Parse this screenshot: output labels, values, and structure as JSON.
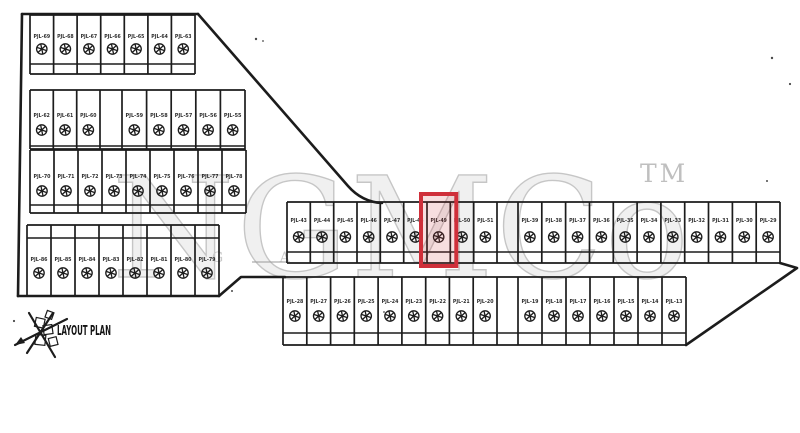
{
  "legend": {
    "title": "LAYOUT PLAN"
  },
  "watermark": {
    "text": "NGMCo",
    "tm": "TM",
    "subtitle": "G A"
  },
  "icons": {
    "plot_marker_icon": "circled-asterisk",
    "north_arrow_icon": "hand-drawn-north-star"
  },
  "style": {
    "ink": "#1c1c1c",
    "highlight_border": "#cf2f3a",
    "highlight_fill": "rgba(207,47,58,0.16)",
    "watermark_color": "#c6c6c6",
    "paper": "#ffffff"
  },
  "highlight": {
    "row_id": "mid-row",
    "group": 0,
    "plot_index": 6,
    "label": "PJL-49"
  },
  "rows": [
    {
      "id": "left-top-row",
      "top": 15,
      "bottom": 74,
      "band": 64,
      "label_y": 38,
      "circle_y": 49,
      "groups": [
        {
          "x0": 30,
          "x1": 195,
          "labels": [
            "PJL-69",
            "PJL-68",
            "PJL-67",
            "PJL-66",
            "PJL-65",
            "PJL-64",
            "PJL-63"
          ]
        }
      ]
    },
    {
      "id": "left-row-2",
      "top": 90,
      "bottom": 149,
      "band": 146,
      "label_y": 117,
      "circle_y": 130,
      "groups": [
        {
          "x0": 30,
          "x1": 100,
          "labels": [
            "PJL-62",
            "PJL-61",
            "PJL-60"
          ]
        },
        {
          "x0": 122,
          "x1": 245,
          "labels": [
            "PJL-59",
            "PJL-58",
            "PJL-57",
            "PJL-56",
            "PJL-55"
          ]
        }
      ]
    },
    {
      "id": "left-row-3",
      "top": 150,
      "bottom": 213,
      "band": 205,
      "label_y": 178,
      "circle_y": 191,
      "groups": [
        {
          "x0": 30,
          "x1": 246,
          "labels": [
            "PJL-70",
            "PJL-71",
            "PJL-72",
            "PJL-73",
            "PJL-74",
            "PJL-75",
            "PJL-76",
            "PJL-77",
            "PJL-78"
          ]
        }
      ]
    },
    {
      "id": "left-bottom-row",
      "top": 225,
      "bottom": 296,
      "band": 238,
      "label_y": 261,
      "circle_y": 273,
      "groups": [
        {
          "x0": 27,
          "x1": 219,
          "labels": [
            "PJL-86",
            "PJL-85",
            "PJL-84",
            "PJL-83",
            "PJL-82",
            "PJL-81",
            "PJL-80",
            "PJL-79"
          ]
        }
      ]
    },
    {
      "id": "mid-row",
      "top": 202,
      "bottom": 263,
      "band": 252,
      "label_y": 222,
      "circle_y": 237,
      "groups": [
        {
          "x0": 287,
          "x1": 497,
          "labels": [
            "PJL-43",
            "PJL-44",
            "PJL-45",
            "PJL-46",
            "PJL-47",
            "PJL-48",
            "PJL-49",
            "PJL-50",
            "PJL-51"
          ]
        },
        {
          "x0": 518,
          "x1": 780,
          "labels": [
            "PJL-39",
            "PJL-38",
            "PJL-37",
            "PJL-36",
            "PJL-35",
            "PJL-34",
            "PJL-33",
            "PJL-32",
            "PJL-31",
            "PJL-30",
            "PJL-29"
          ]
        }
      ]
    },
    {
      "id": "bottom-row",
      "top": 277,
      "bottom": 345,
      "band": 333,
      "label_y": 303,
      "circle_y": 316,
      "groups": [
        {
          "x0": 283,
          "x1": 497,
          "labels": [
            "PJL-28",
            "PJL-27",
            "PJL-26",
            "PJL-25",
            "PJL-24",
            "PJL-23",
            "PJL-22",
            "PJL-21",
            "PJL-20"
          ]
        },
        {
          "x0": 518,
          "x1": 686,
          "labels": [
            "PJL-19",
            "PJL-18",
            "PJL-17",
            "PJL-16",
            "PJL-15",
            "PJL-14",
            "PJL-13"
          ]
        }
      ]
    }
  ]
}
